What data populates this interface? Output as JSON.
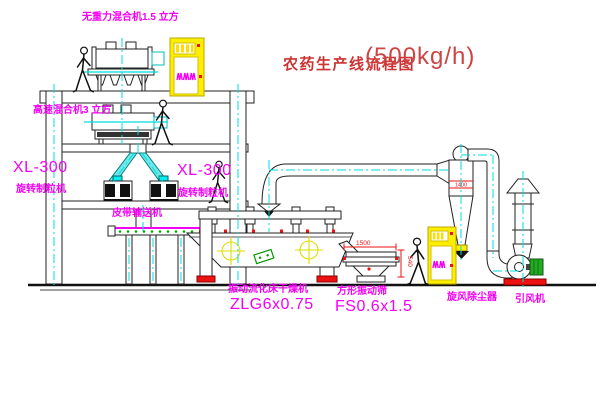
{
  "title": {
    "text": "农药生产线流程图",
    "capacity": "(500kg/h)"
  },
  "equipment": {
    "gravity_mixer": {
      "label": "无重力混合机1.5 立方"
    },
    "high_speed_mixer": {
      "label": "高速混合机3 立方"
    },
    "granulator_left": {
      "model": "XL-300",
      "name": "旋转制粒机"
    },
    "granulator_right": {
      "model": "XL-300",
      "name": "旋转制粒机"
    },
    "belt_conveyor": {
      "name": "皮带输送机"
    },
    "fluid_bed_dryer": {
      "name": "振动流化床干燥机",
      "model": "ZLG6x0.75"
    },
    "vibrating_sieve": {
      "name": "方形振动筛",
      "model": "FS0.6x1.5"
    },
    "cyclone": {
      "name": "旋风除尘器",
      "dimension": "1400"
    },
    "induced_draft_fan": {
      "name": "引风机"
    }
  },
  "dimensions": {
    "sieve_length": "1500",
    "sieve_height": "540"
  },
  "colors": {
    "label_magenta": "#f400f4",
    "title_red": "#cc3333",
    "centerline_cyan": "#00dcdc",
    "cabinet_yellow": "#ffee00",
    "accent_red": "#ee1111",
    "accent_green": "#22aa22",
    "line": "#222222"
  }
}
